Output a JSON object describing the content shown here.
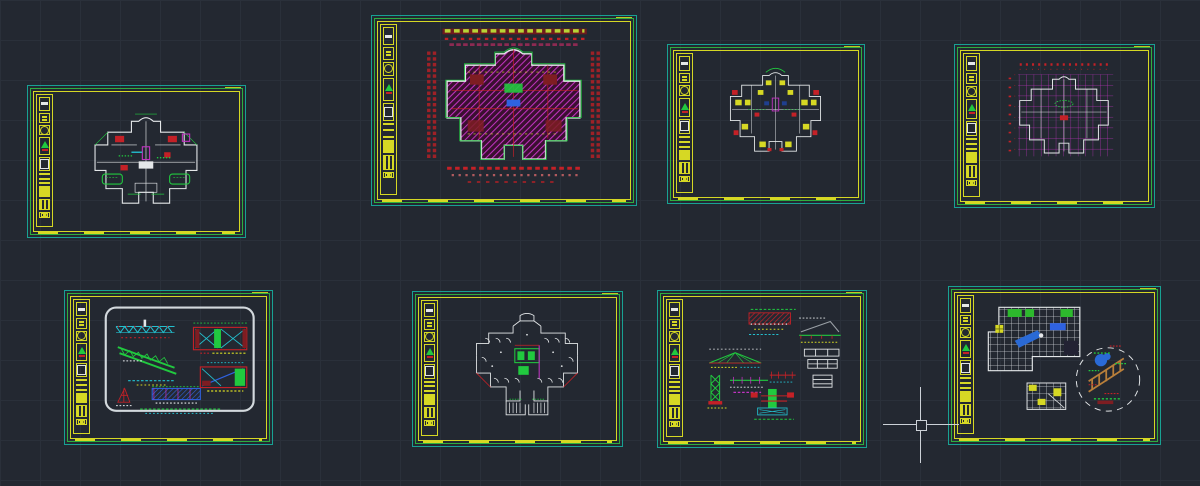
{
  "app": {
    "name": "CAD model space canvas",
    "background": "#232831",
    "grid_color": "#2a303a",
    "grid_spacing_px": 40
  },
  "palette": {
    "frame_teal": "#18a193",
    "frame_green": "#2fae3e",
    "frame_yellow": "#d6d824",
    "wall_white": "#e4e7e9",
    "red": "#c42127",
    "dark_red": "#7e1d22",
    "magenta": "#c233c2",
    "green": "#21c93f",
    "cyan": "#23c0cf",
    "blue": "#2f62e0",
    "orange": "#b97f3a",
    "yellowgreen_text": "#b7d435"
  },
  "cursor": {
    "x": 921,
    "y": 425,
    "arm_px": 76,
    "pickbox_px": 9,
    "color": "#ccd1d7"
  },
  "sheets": [
    {
      "id": "s1",
      "name": "floor plan — color-coded layout",
      "type": "floor-plan",
      "dominant_colors": [
        "white",
        "green",
        "red",
        "magenta"
      ]
    },
    {
      "id": "s2",
      "name": "floor plan — dense magenta hatch with red dimensions",
      "type": "floor-plan",
      "dominant_colors": [
        "magenta",
        "red",
        "white",
        "green"
      ]
    },
    {
      "id": "s3",
      "name": "floor plan — furniture blocks yellow/red",
      "type": "floor-plan",
      "dominant_colors": [
        "white",
        "yellow",
        "red",
        "green"
      ]
    },
    {
      "id": "s4",
      "name": "structural grid plan — magenta axes",
      "type": "floor-plan",
      "dominant_colors": [
        "white",
        "magenta",
        "red"
      ]
    },
    {
      "id": "s5",
      "name": "truss and beam details in rounded viewport",
      "type": "detail-sheet",
      "dominant_colors": [
        "green",
        "cyan",
        "blue",
        "red"
      ]
    },
    {
      "id": "s6",
      "name": "floor plan — sparse walls with core",
      "type": "floor-plan",
      "dominant_colors": [
        "white",
        "green",
        "red",
        "magenta"
      ]
    },
    {
      "id": "s7",
      "name": "assorted structural details",
      "type": "detail-sheet",
      "dominant_colors": [
        "red",
        "green",
        "cyan",
        "magenta",
        "white"
      ]
    },
    {
      "id": "s8",
      "name": "ceiling grid plan with circular landscape detail",
      "type": "detail-sheet",
      "dominant_colors": [
        "white",
        "green",
        "blue",
        "yellow",
        "orange"
      ]
    }
  ],
  "frame": {
    "outer_border": "teal",
    "middle_border": "green",
    "inner_border": "yellow",
    "title_block_side": "left",
    "title_block_cells": [
      "title-bar",
      "text-glyphs",
      "circle-seal",
      "logo-triangle",
      "stamp-box",
      "bars",
      "solid-highlight",
      "dash-text",
      "h-glyph"
    ]
  }
}
